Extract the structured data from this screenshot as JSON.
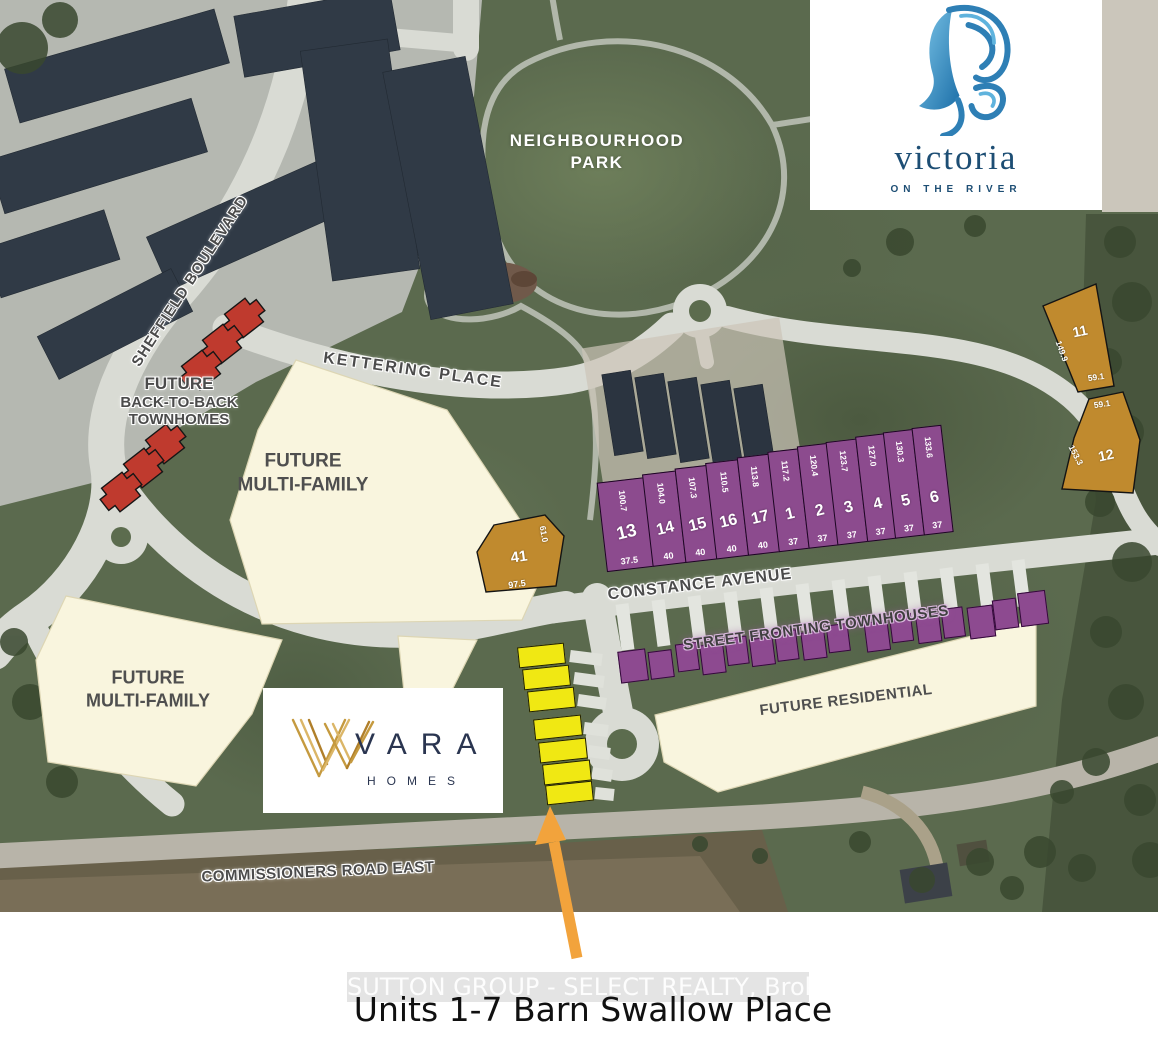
{
  "branding": {
    "victoria": {
      "wordmark": "victoria",
      "tagline": "ON THE RIVER"
    },
    "vara": {
      "wordmark": "VARA",
      "tagline": "HOMES"
    }
  },
  "map_labels": {
    "park": "NEIGHBOURHOOD PARK",
    "sheffield_blvd": "SHEFFIELD BOULEVARD",
    "kettering_pl": "KETTERING PLACE",
    "constance_ave": "CONSTANCE AVENUE",
    "commissioners_rd": "COMMISSIONERS ROAD EAST",
    "btb_line1": "FUTURE",
    "btb_line2": "BACK-TO-BACK",
    "btb_line3": "TOWNHOMES",
    "mf_upper_line1": "FUTURE",
    "mf_upper_line2": "MULTI-FAMILY",
    "mf_lower_line1": "FUTURE",
    "mf_lower_line2": "MULTI-FAMILY",
    "street_fronting": "STREET FRONTING TOWNHOUSES",
    "future_residential": "FUTURE RESIDENTIAL"
  },
  "purple_lots": [
    {
      "number": "13",
      "depth": "100.7",
      "width": "37.5"
    },
    {
      "number": "14",
      "depth": "104.0",
      "width": "40"
    },
    {
      "number": "15",
      "depth": "107.3",
      "width": "40"
    },
    {
      "number": "16",
      "depth": "110.5",
      "width": "40"
    },
    {
      "number": "17",
      "depth": "113.8",
      "width": "40"
    },
    {
      "number": "1",
      "depth": "117.2",
      "width": "37"
    },
    {
      "number": "2",
      "depth": "120.4",
      "width": "37"
    },
    {
      "number": "3",
      "depth": "123.7",
      "width": "37"
    },
    {
      "number": "4",
      "depth": "127.0",
      "width": "37"
    },
    {
      "number": "5",
      "depth": "130.3",
      "width": "37"
    },
    {
      "number": "6",
      "depth": "133.6",
      "width": "37"
    }
  ],
  "brown_lots": {
    "lot41": {
      "number": "41",
      "side": "61.0",
      "front": "97.5"
    },
    "lot11": {
      "number": "11",
      "side": "149.9",
      "front": "59.1"
    },
    "lot12": {
      "number": "12",
      "rear": "59.1",
      "side": "153.3"
    }
  },
  "footer": {
    "watermark": "SUTTON GROUP - SELECT REALTY, Brokerage",
    "caption": "Units 1-7 Barn Swallow Place"
  },
  "colors": {
    "lot_purple": "#8c4b8e",
    "lot_gold": "#c08a2e",
    "unit_yellow": "#f0e813",
    "block_red": "#bf3a2e",
    "parcel_cream": "#f9f5de",
    "arrow_orange": "#f2a33c",
    "road_gray": "#d9dbd4",
    "brand_navy": "#1d4e74"
  }
}
